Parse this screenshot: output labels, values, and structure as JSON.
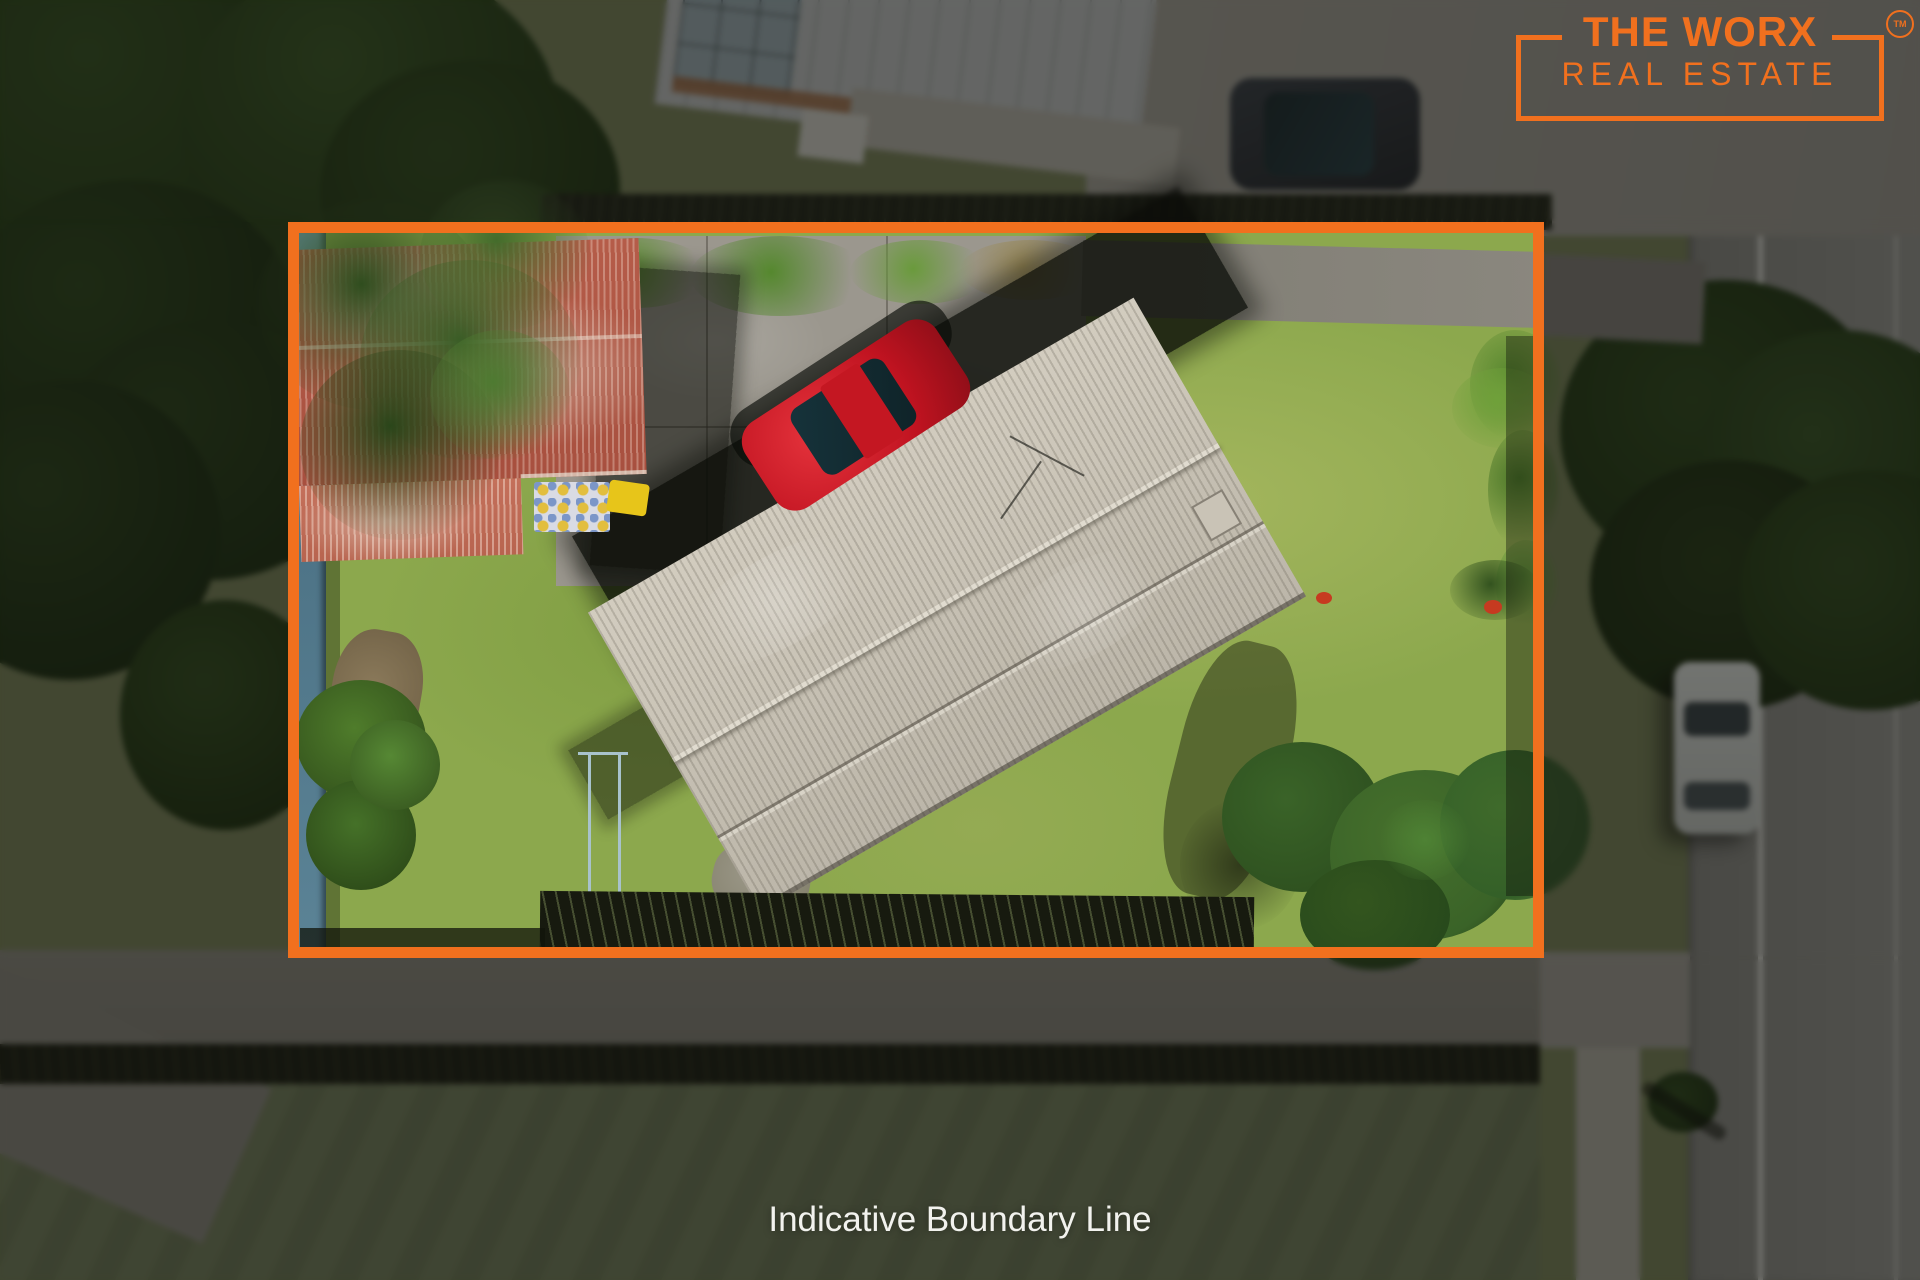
{
  "branding": {
    "name_line1": "THE WORX",
    "name_line2": "REAL ESTATE",
    "trademark": "TM",
    "brand_color": "#F1701E"
  },
  "caption": {
    "text": "Indicative Boundary Line",
    "text_color": "#F2F2EE"
  },
  "boundary_overlay": {
    "stroke_color": "#F1701E",
    "outside_dim_color": "rgba(13,13,10,0.52)"
  },
  "scene_palette": {
    "lawn_green": "#8CA84D",
    "house_roof_grey": "#C9C3B6",
    "shed_roof_red": "#B55C49",
    "car_red": "#C01320",
    "driveway_concrete": "#9B978E",
    "road_asphalt": "#90908B",
    "tree_canopy": "#2F4D1E",
    "left_fence_blue": "#4E7487"
  }
}
